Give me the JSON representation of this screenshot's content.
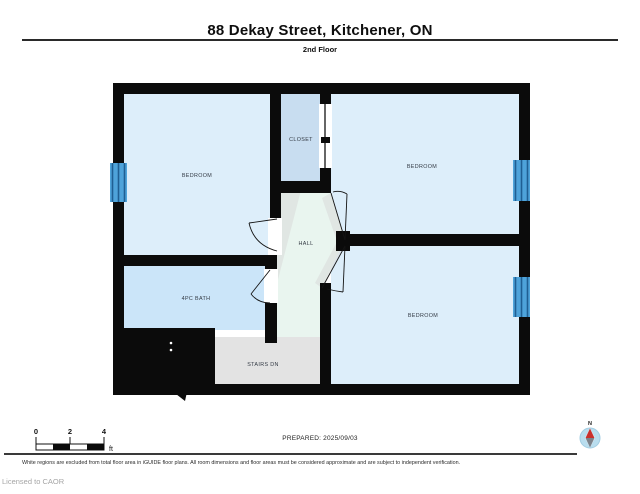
{
  "header": {
    "title": "88 Dekay Street, Kitchener, ON",
    "subtitle": "2nd Floor"
  },
  "floorplan": {
    "rooms": [
      {
        "id": "bedroom-left",
        "label": "BEDROOM"
      },
      {
        "id": "closet",
        "label": "CLOSET"
      },
      {
        "id": "bedroom-top-right",
        "label": "BEDROOM"
      },
      {
        "id": "hall",
        "label": "HALL"
      },
      {
        "id": "bath",
        "label": "4PC BATH"
      },
      {
        "id": "bedroom-bottom-right",
        "label": "BEDROOM"
      },
      {
        "id": "stairs",
        "label": "STAIRS DN"
      }
    ],
    "colors": {
      "wall": "#0b0b0b",
      "bedroom_fill": "#ddeefa",
      "closet_fill": "#c8ddf0",
      "bath_fill": "#cbe5f9",
      "hall_fill": "#e9f5ef",
      "stairs_fill": "#e3e3e3",
      "window_blue": "#4ea3da",
      "window_stripe": "#1f5f93",
      "compass_circle": "#b9ddee",
      "compass_red": "#c9302c"
    }
  },
  "scale_bar": {
    "ticks": [
      "0",
      "2",
      "4"
    ],
    "unit": "ft"
  },
  "prepared": {
    "label": "PREPARED: 2025/09/03"
  },
  "compass": {
    "label": "N"
  },
  "footer": {
    "disclaimer": "White regions are excluded from total floor area in iGUIDE floor plans. All room dimensions and floor areas must be considered approximate and are subject to independent verification.",
    "license": "Licensed to CAOR"
  }
}
